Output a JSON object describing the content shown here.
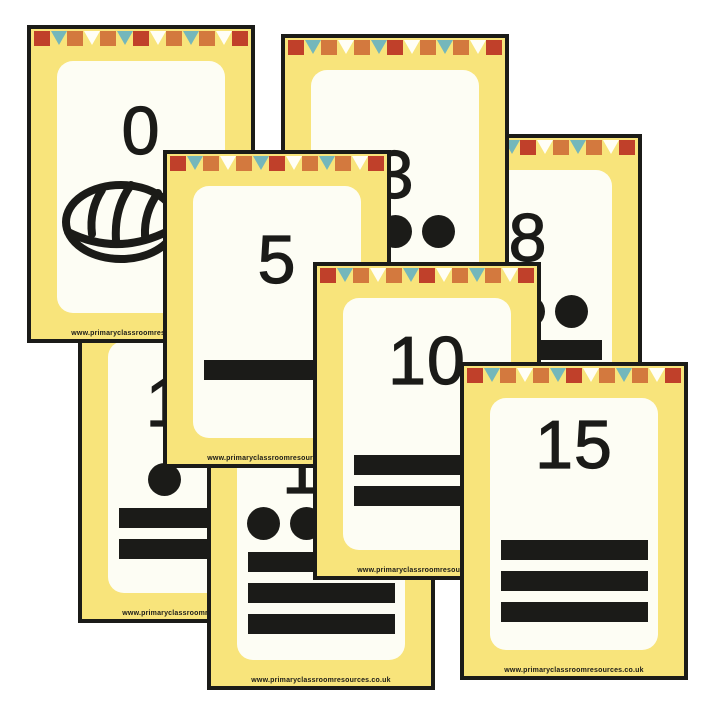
{
  "palette": {
    "black": "#1b1b18",
    "yellow": "#f8e47b",
    "panel_white": "#fdfdf4",
    "flag_red": "#c0402a",
    "flag_orange": "#d3793e",
    "flag_teal": "#74b7bb",
    "flag_white": "#fffef6"
  },
  "footer_url": "www.primaryclassroomresources.co.uk",
  "bunting_pattern": [
    {
      "shape": "square",
      "color": "flag_red"
    },
    {
      "shape": "triangle",
      "color": "flag_teal"
    },
    {
      "shape": "square",
      "color": "flag_orange"
    },
    {
      "shape": "triangle",
      "color": "flag_white"
    },
    {
      "shape": "square",
      "color": "flag_orange"
    },
    {
      "shape": "triangle",
      "color": "flag_teal"
    },
    {
      "shape": "square",
      "color": "flag_red"
    },
    {
      "shape": "triangle",
      "color": "flag_white"
    },
    {
      "shape": "square",
      "color": "flag_orange"
    },
    {
      "shape": "triangle",
      "color": "flag_teal"
    },
    {
      "shape": "square",
      "color": "flag_orange"
    },
    {
      "shape": "triangle",
      "color": "flag_white"
    },
    {
      "shape": "square",
      "color": "flag_red"
    }
  ],
  "cards": [
    {
      "number": "11",
      "mayan": {
        "shell": false,
        "dots": 1,
        "bars": 2
      },
      "position": {
        "left": 78,
        "top": 305,
        "z": 1
      }
    },
    {
      "number": "8",
      "mayan": {
        "shell": false,
        "dots": 3,
        "bars": 1
      },
      "position": {
        "left": 414,
        "top": 134,
        "z": 2
      }
    },
    {
      "number": "0",
      "mayan": {
        "shell": true,
        "dots": 0,
        "bars": 0
      },
      "position": {
        "left": 27,
        "top": 25,
        "z": 3
      }
    },
    {
      "number": "3",
      "mayan": {
        "shell": false,
        "dots": 3,
        "bars": 0
      },
      "position": {
        "left": 281,
        "top": 34,
        "z": 4
      }
    },
    {
      "number": "17",
      "mayan": {
        "shell": false,
        "dots": 2,
        "bars": 3
      },
      "position": {
        "left": 207,
        "top": 372,
        "z": 5
      }
    },
    {
      "number": "5",
      "mayan": {
        "shell": false,
        "dots": 0,
        "bars": 1
      },
      "position": {
        "left": 163,
        "top": 150,
        "z": 6
      }
    },
    {
      "number": "10",
      "mayan": {
        "shell": false,
        "dots": 0,
        "bars": 2
      },
      "position": {
        "left": 313,
        "top": 262,
        "z": 7
      }
    },
    {
      "number": "15",
      "mayan": {
        "shell": false,
        "dots": 0,
        "bars": 3
      },
      "position": {
        "left": 460,
        "top": 362,
        "z": 8
      }
    }
  ]
}
